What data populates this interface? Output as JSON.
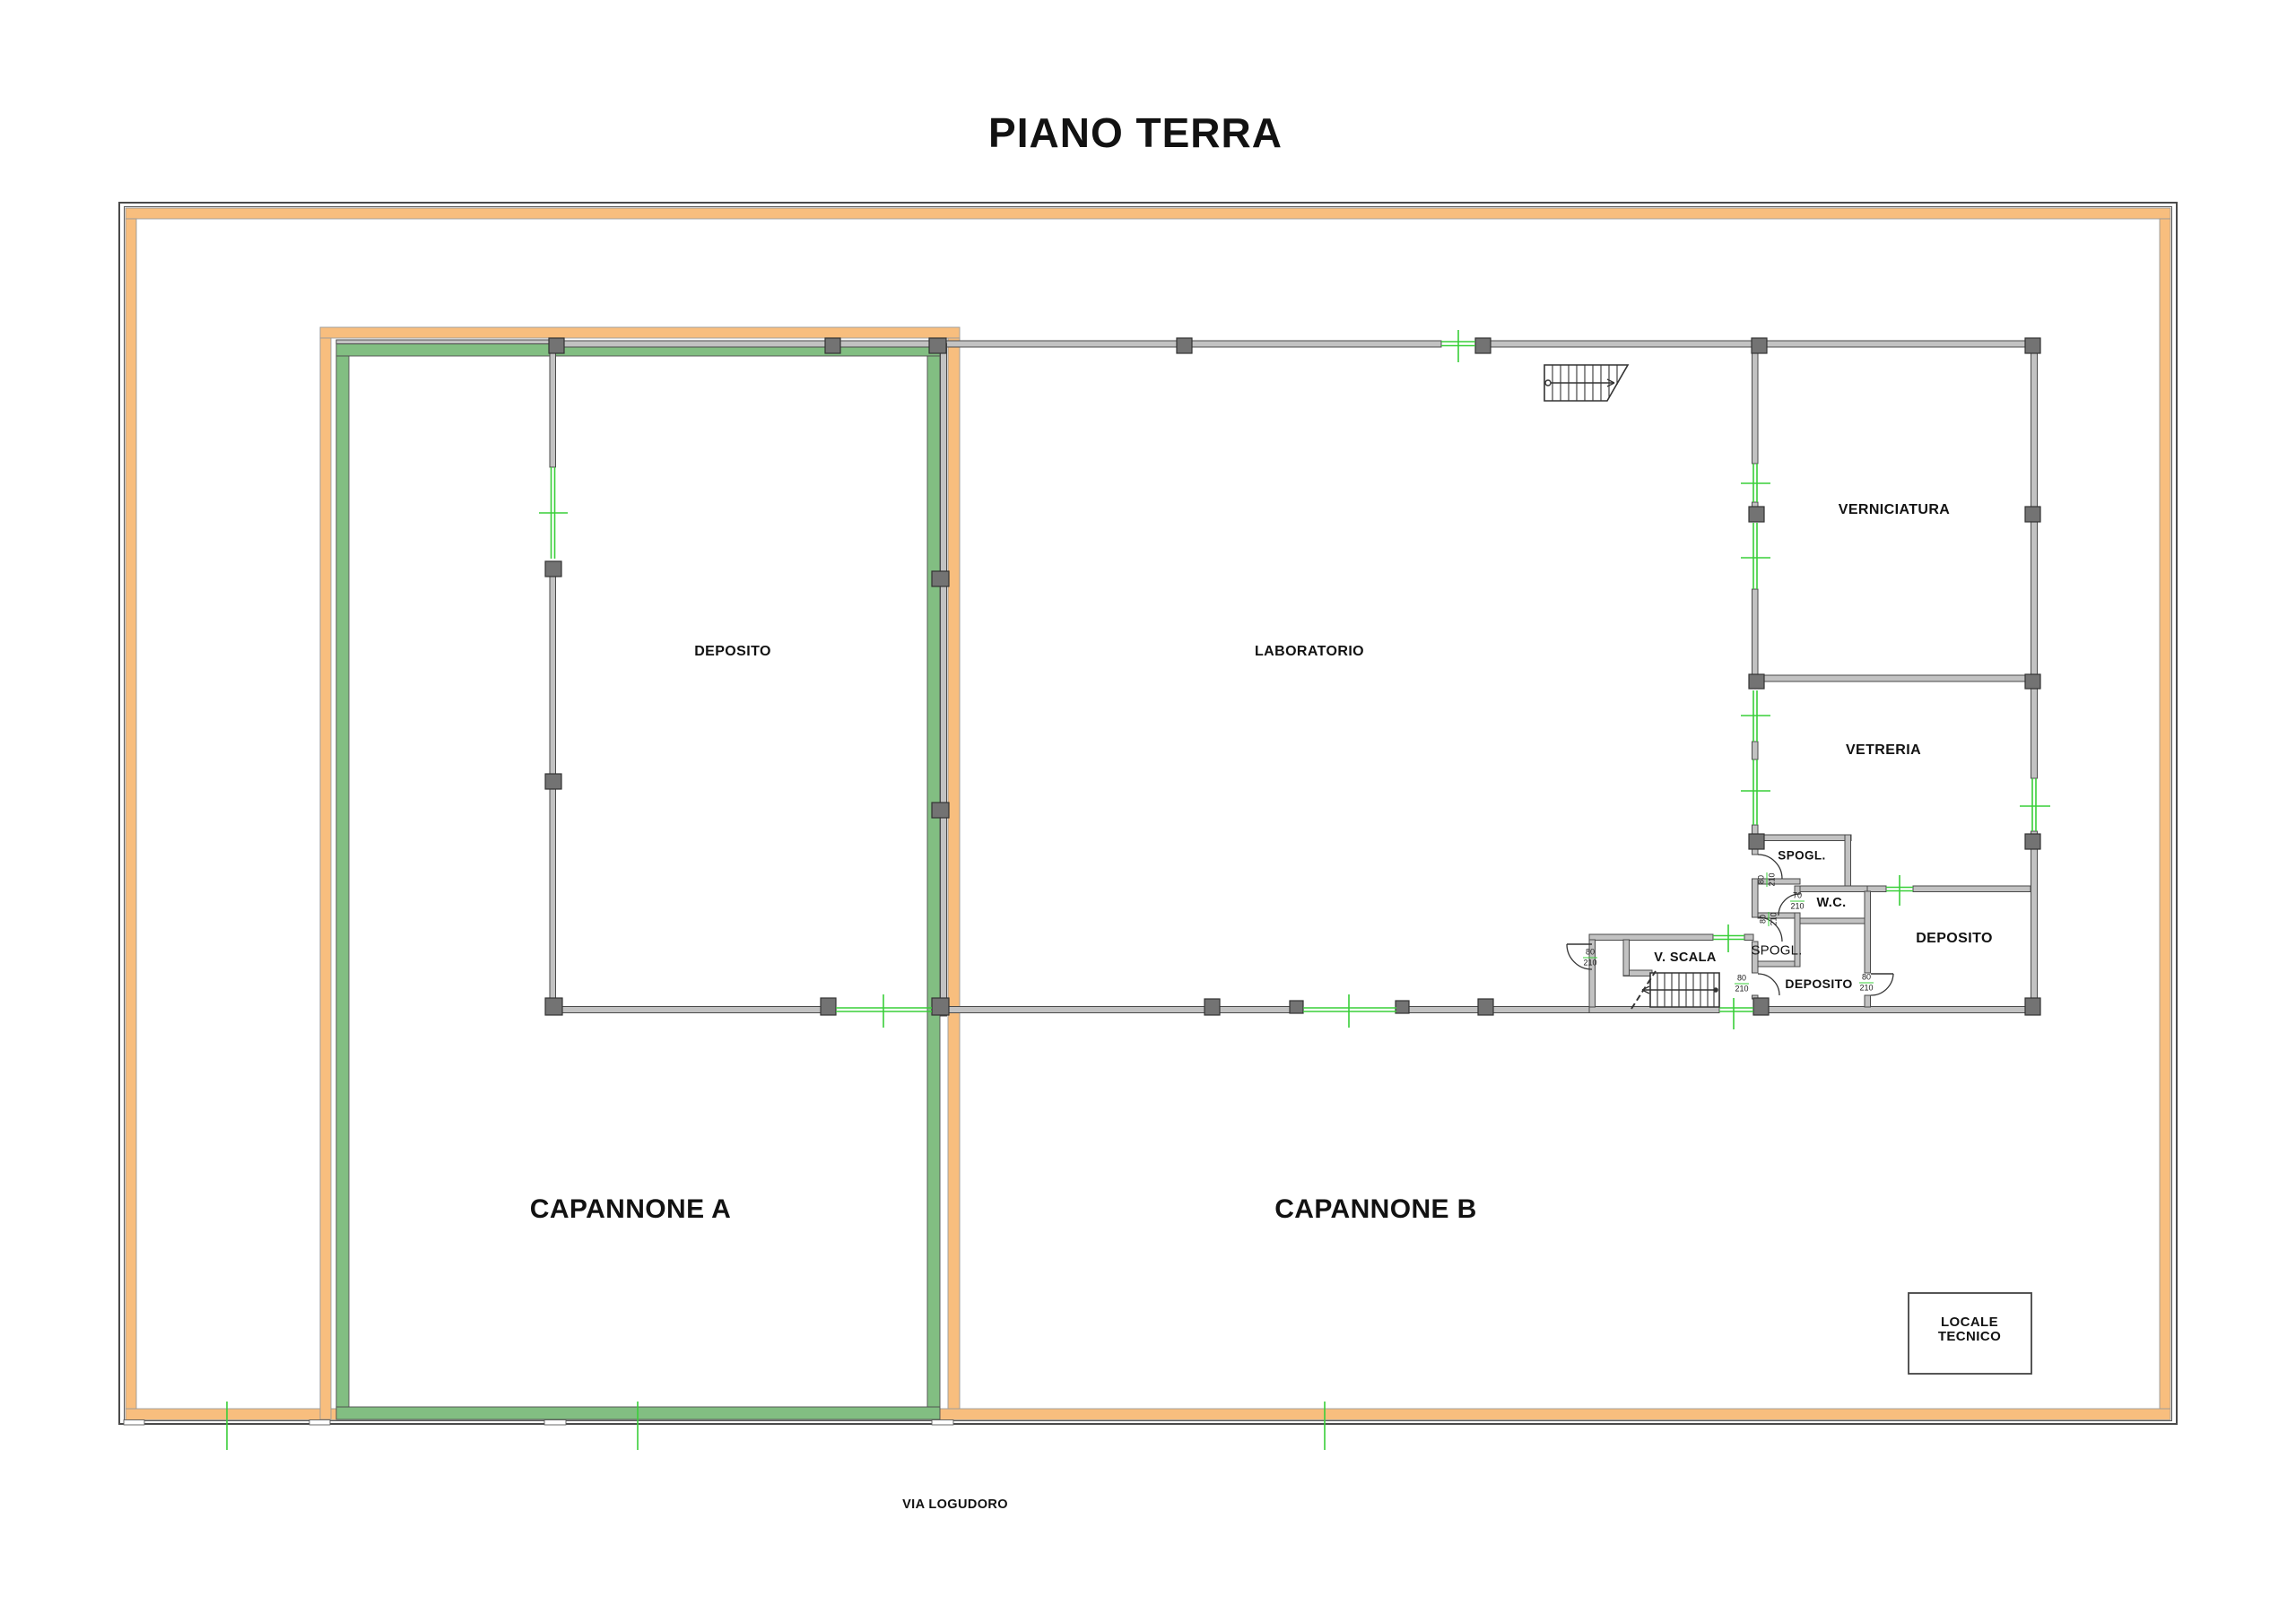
{
  "title": "PIANO TERRA",
  "street": "VIA LOGUDORO",
  "buildings": {
    "a": "CAPANNONE A",
    "b": "CAPANNONE B"
  },
  "rooms": {
    "deposito_a": "DEPOSITO",
    "laboratorio": "LABORATORIO",
    "verniciatura": "VERNICIATURA",
    "vetreria": "VETRERIA",
    "spogl_up": "SPOGL.",
    "wc": "W.C.",
    "spogl_low": "SPOGL.",
    "deposito_small": "DEPOSITO",
    "deposito_big": "DEPOSITO",
    "v_scala": "V. SCALA",
    "locale_tecnico": "LOCALE\nTECNICO"
  },
  "dimensions": {
    "spogl_up_door": {
      "w": "80",
      "h": "210"
    },
    "wc_door": {
      "w": "70",
      "h": "210"
    },
    "spogl_low_door": {
      "w": "80",
      "h": "210"
    },
    "v_scala_door": {
      "w": "80",
      "h": "210"
    },
    "deposito_small_west_door": {
      "w": "80",
      "h": "210"
    },
    "deposito_small_east_door": {
      "w": "80",
      "h": "210"
    }
  },
  "colors": {
    "lot_b_outline": "#F8BE7E",
    "lot_b_stroke": "#9a9a9a",
    "lot_a_outline": "#82BE82",
    "lot_a_stroke": "#4d4d4d",
    "opening_marker": "#39CF39",
    "wall_fill": "#C2C2C2",
    "wall_stroke": "#4a4a4a",
    "pillar_fill": "#737373",
    "pillar_stroke": "#333333",
    "boundary_stroke": "#4a4a4a",
    "stair_stroke": "#333333"
  }
}
